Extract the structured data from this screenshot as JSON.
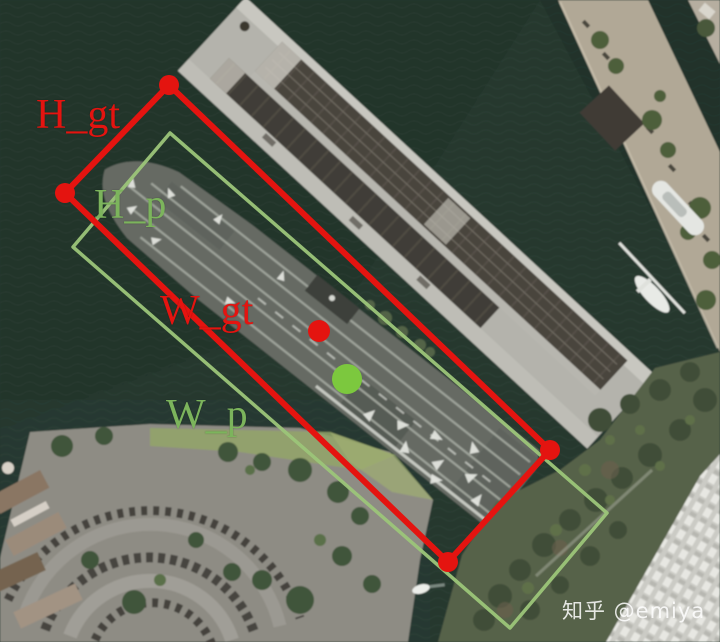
{
  "annotations": {
    "ground_truth": {
      "height_label": "H_gt",
      "width_label": "W_gt",
      "color": "#e41410",
      "box_corners": [
        [
          169,
          85
        ],
        [
          65,
          193
        ],
        [
          448,
          562
        ],
        [
          550,
          450
        ]
      ],
      "center_point": [
        319,
        331
      ]
    },
    "prediction": {
      "height_label": "H_p",
      "width_label": "W_p",
      "line_color": "#9cc579",
      "text_color": "#7cb45c",
      "dot_color": "#7cc83e",
      "box_corners": [
        [
          170,
          133
        ],
        [
          73,
          247
        ],
        [
          510,
          628
        ],
        [
          607,
          513
        ]
      ],
      "center_point": [
        347,
        379
      ]
    }
  },
  "watermark": {
    "text": "知乎 @emiya",
    "color": "#ffffff"
  }
}
